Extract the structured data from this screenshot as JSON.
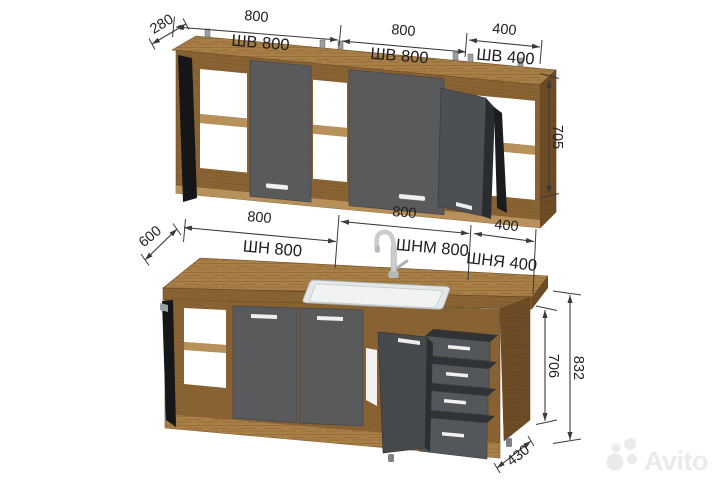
{
  "drawing": {
    "wall_row": {
      "depth": "280",
      "height": "705",
      "cabinets": [
        {
          "width": "800",
          "label": "ШВ 800"
        },
        {
          "width": "800",
          "label": "ШВ 800"
        },
        {
          "width": "400",
          "label": "ШВ 400"
        }
      ]
    },
    "base_row": {
      "depth": "600",
      "cabinet_height": "706",
      "total_height": "832",
      "plinth_depth": "430",
      "cabinets": [
        {
          "width": "800",
          "label": "ШН 800"
        },
        {
          "width": "800",
          "label": "ШНМ 800"
        },
        {
          "width": "400",
          "label": "ШНЯ 400"
        }
      ]
    },
    "colors": {
      "wood_frame": "#8a6334",
      "wood_top": "#a87f46",
      "wood_dark": "#6e4d26",
      "door_gray": "#585a5c",
      "open_door_gray": "#46494b",
      "dimension_line": "#3a3a3a",
      "text": "#1f1f1f",
      "watermark_gray": "#ebebeb",
      "background": "#ffffff"
    }
  },
  "watermark": {
    "brand": "Avito"
  }
}
